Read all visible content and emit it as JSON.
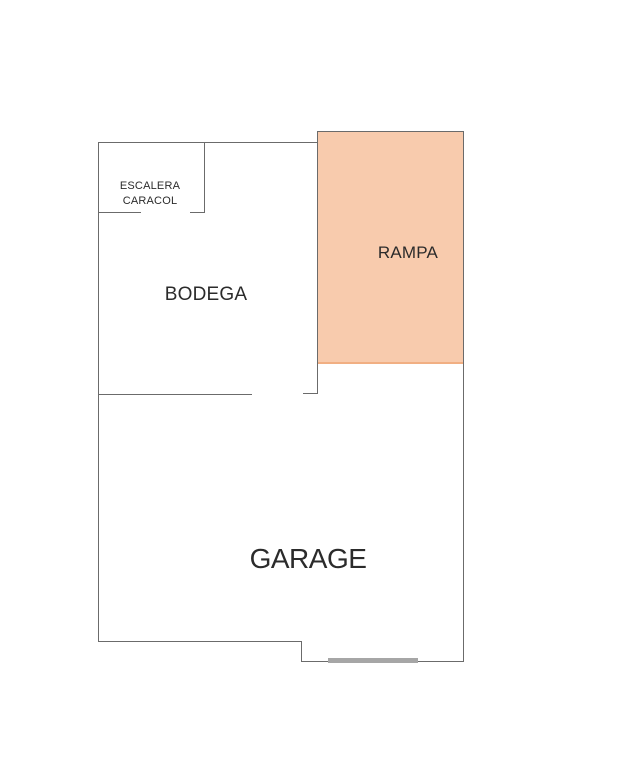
{
  "colors": {
    "background": "#ffffff",
    "wall": "#6b6b6b",
    "text": "#2b2b2b",
    "ramp_fill": "#f8cbad",
    "ramp_edge": "#f1af83",
    "garage_door": "#a6a6a6"
  },
  "rooms": {
    "escalera": {
      "label_line1": "ESCALERA",
      "label_line2": "CARACOL"
    },
    "bodega": {
      "label": "BODEGA"
    },
    "rampa": {
      "label": "RAMPA"
    },
    "garage": {
      "label": "GARAGE"
    }
  }
}
